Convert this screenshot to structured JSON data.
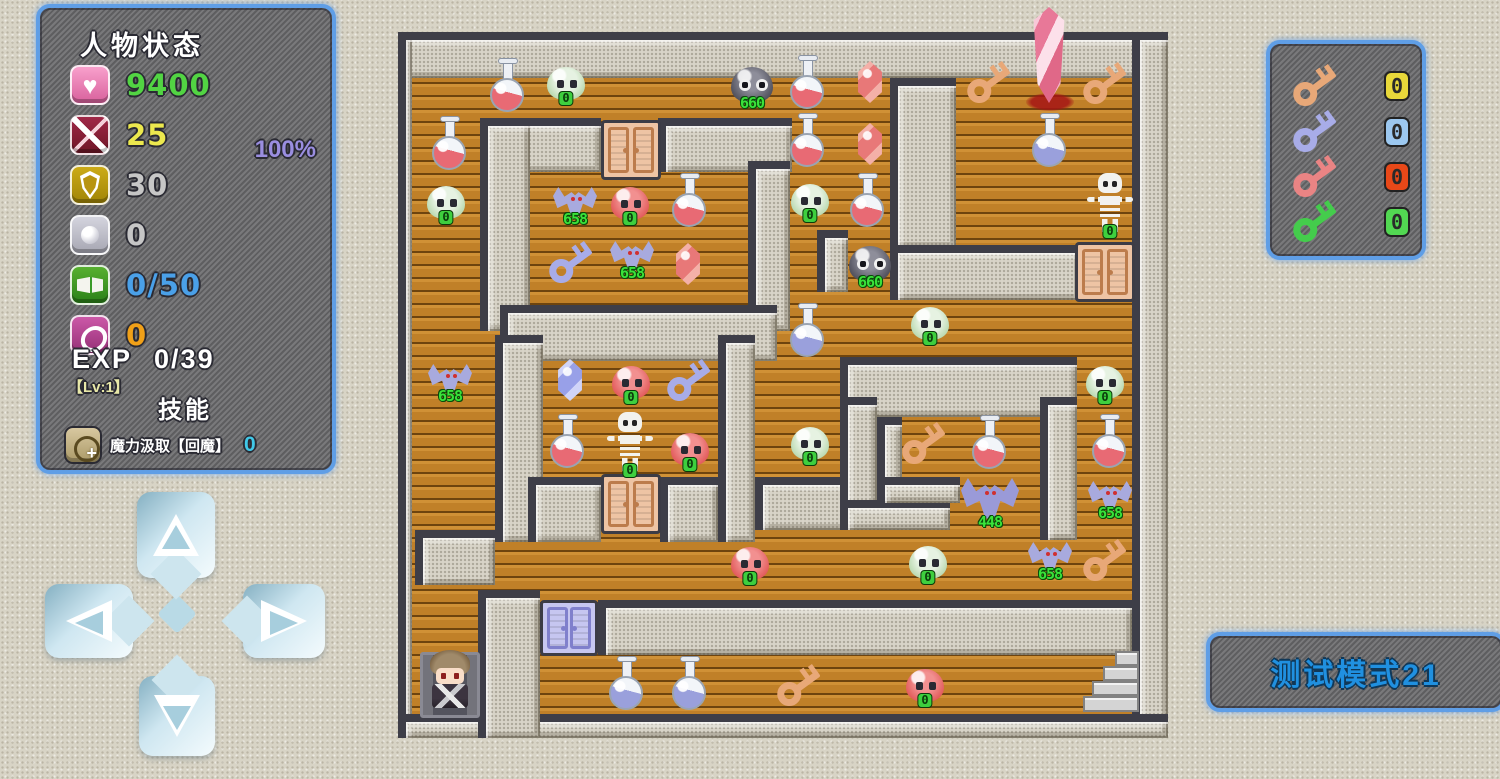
{
  "colors": {
    "panel_border": "#5f9ee6",
    "hp_green": "#52d443",
    "atk_yellow": "#ece84e",
    "def_gray": "#c6c6c6",
    "mana_blue": "#4aa0e8",
    "coin_orange": "#f0a018",
    "percent_purple": "#9a8ee0",
    "skill_cyan": "#40c8e8",
    "monster_number_green": "#3ae23a",
    "test_mode_blue": "#2090e0"
  },
  "status_panel": {
    "title": "人物状态",
    "rows": [
      {
        "icon": "heart-icon",
        "value": "9400"
      },
      {
        "icon": "sword-icon",
        "value": "25"
      },
      {
        "icon": "shield-icon",
        "value": "30"
      },
      {
        "icon": "orb-icon",
        "value": "0"
      },
      {
        "icon": "book-icon",
        "value": "0/50"
      },
      {
        "icon": "coin-icon",
        "value": "0"
      }
    ],
    "percent": "100%",
    "exp_label": "EXP",
    "exp_value": "0/39",
    "level": "【Lv:1】",
    "skills_title": "技能",
    "skill_name": "魔力汲取【回魔】",
    "skill_value": "0"
  },
  "keys_panel": {
    "keys": [
      {
        "name": "orange-key",
        "count": "0"
      },
      {
        "name": "blue-key",
        "count": "0"
      },
      {
        "name": "red-key",
        "count": "0"
      },
      {
        "name": "green-key",
        "count": "0"
      }
    ]
  },
  "test_mode_label": "测试模式21",
  "dpad": {
    "buttons": [
      "up",
      "left",
      "right",
      "down"
    ]
  },
  "maze": {
    "walls": [
      [
        0,
        10,
        770,
        46
      ],
      [
        0,
        10,
        14,
        706
      ],
      [
        734,
        10,
        36,
        706
      ],
      [
        0,
        692,
        770,
        24
      ],
      [
        492,
        56,
        66,
        170
      ],
      [
        492,
        223,
        190,
        55
      ],
      [
        82,
        96,
        121,
        54
      ],
      [
        260,
        96,
        134,
        54
      ],
      [
        82,
        96,
        50,
        213
      ],
      [
        350,
        139,
        42,
        170
      ],
      [
        102,
        283,
        277,
        56
      ],
      [
        419,
        208,
        31,
        62
      ],
      [
        97,
        313,
        48,
        207
      ],
      [
        320,
        313,
        37,
        207
      ],
      [
        130,
        455,
        73,
        65
      ],
      [
        262,
        455,
        58,
        65
      ],
      [
        357,
        455,
        145,
        53
      ],
      [
        17,
        508,
        80,
        55
      ],
      [
        80,
        568,
        62,
        148
      ],
      [
        200,
        578,
        534,
        55
      ],
      [
        442,
        335,
        237,
        60
      ],
      [
        442,
        375,
        37,
        133
      ],
      [
        442,
        478,
        110,
        30
      ],
      [
        642,
        375,
        37,
        143
      ],
      [
        479,
        395,
        25,
        82
      ],
      [
        479,
        455,
        83,
        26
      ]
    ],
    "items": [
      {
        "type": "niche",
        "x": 52,
        "y": 663
      },
      {
        "type": "hero",
        "x": 52,
        "y": 659
      },
      {
        "type": "door-orange",
        "x": 233,
        "y": 128
      },
      {
        "type": "door-orange",
        "x": 233,
        "y": 482
      },
      {
        "type": "door-orange",
        "x": 707,
        "y": 250
      },
      {
        "type": "door-blue",
        "x": 171,
        "y": 606
      },
      {
        "type": "crystal",
        "x": 651,
        "y": 33
      },
      {
        "type": "pool",
        "x": 652,
        "y": 80
      },
      {
        "type": "stairs",
        "x": 712,
        "y": 660
      },
      {
        "type": "potion-red",
        "x": 110,
        "y": 63
      },
      {
        "type": "potion-red",
        "x": 52,
        "y": 121
      },
      {
        "type": "potion-red",
        "x": 410,
        "y": 60
      },
      {
        "type": "potion-red",
        "x": 410,
        "y": 118
      },
      {
        "type": "potion-red",
        "x": 470,
        "y": 178
      },
      {
        "type": "potion-red",
        "x": 292,
        "y": 178
      },
      {
        "type": "potion-red",
        "x": 170,
        "y": 419
      },
      {
        "type": "potion-red",
        "x": 592,
        "y": 420
      },
      {
        "type": "potion-red",
        "x": 712,
        "y": 419
      },
      {
        "type": "potion-blue",
        "x": 410,
        "y": 308
      },
      {
        "type": "potion-blue",
        "x": 652,
        "y": 118
      },
      {
        "type": "potion-blue",
        "x": 229,
        "y": 661
      },
      {
        "type": "potion-blue",
        "x": 292,
        "y": 661
      },
      {
        "type": "gem-red",
        "x": 472,
        "y": 60
      },
      {
        "type": "gem-red",
        "x": 472,
        "y": 122
      },
      {
        "type": "gem-red",
        "x": 290,
        "y": 242
      },
      {
        "type": "gem-blue",
        "x": 172,
        "y": 358
      },
      {
        "type": "slime-green",
        "x": 168,
        "y": 61,
        "val": "0"
      },
      {
        "type": "slime-green",
        "x": 48,
        "y": 180,
        "val": "0"
      },
      {
        "type": "slime-green",
        "x": 412,
        "y": 178,
        "val": "0"
      },
      {
        "type": "slime-green",
        "x": 532,
        "y": 301,
        "val": "0"
      },
      {
        "type": "slime-green",
        "x": 707,
        "y": 360,
        "val": "0"
      },
      {
        "type": "slime-green",
        "x": 412,
        "y": 421,
        "val": "0"
      },
      {
        "type": "slime-green",
        "x": 530,
        "y": 540,
        "val": "0"
      },
      {
        "type": "slime-red",
        "x": 232,
        "y": 181,
        "val": "0"
      },
      {
        "type": "slime-red",
        "x": 233,
        "y": 360,
        "val": "0"
      },
      {
        "type": "slime-red",
        "x": 292,
        "y": 427,
        "val": "0"
      },
      {
        "type": "slime-red",
        "x": 352,
        "y": 541,
        "val": "0"
      },
      {
        "type": "slime-red",
        "x": 527,
        "y": 663,
        "val": "0"
      },
      {
        "type": "slime-dark",
        "x": 354,
        "y": 63,
        "val": "660"
      },
      {
        "type": "slime-dark",
        "x": 472,
        "y": 242,
        "val": "660"
      },
      {
        "type": "bat",
        "x": 177,
        "y": 181,
        "val": "658"
      },
      {
        "type": "bat",
        "x": 234,
        "y": 235,
        "val": "658"
      },
      {
        "type": "bat",
        "x": 52,
        "y": 358,
        "val": "658"
      },
      {
        "type": "bat",
        "x": 712,
        "y": 475,
        "val": "658"
      },
      {
        "type": "bat",
        "x": 652,
        "y": 536,
        "val": "658"
      },
      {
        "type": "bat-big",
        "x": 592,
        "y": 478,
        "val": "448"
      },
      {
        "type": "key-orange",
        "x": 592,
        "y": 60
      },
      {
        "type": "key-orange",
        "x": 708,
        "y": 61
      },
      {
        "type": "key-orange",
        "x": 527,
        "y": 421
      },
      {
        "type": "key-orange",
        "x": 708,
        "y": 538
      },
      {
        "type": "key-orange",
        "x": 402,
        "y": 663
      },
      {
        "type": "key-blue",
        "x": 174,
        "y": 240
      },
      {
        "type": "key-blue",
        "x": 292,
        "y": 358
      },
      {
        "type": "skeleton",
        "x": 712,
        "y": 181,
        "val": "0"
      },
      {
        "type": "skeleton",
        "x": 232,
        "y": 420,
        "val": "0"
      }
    ]
  }
}
